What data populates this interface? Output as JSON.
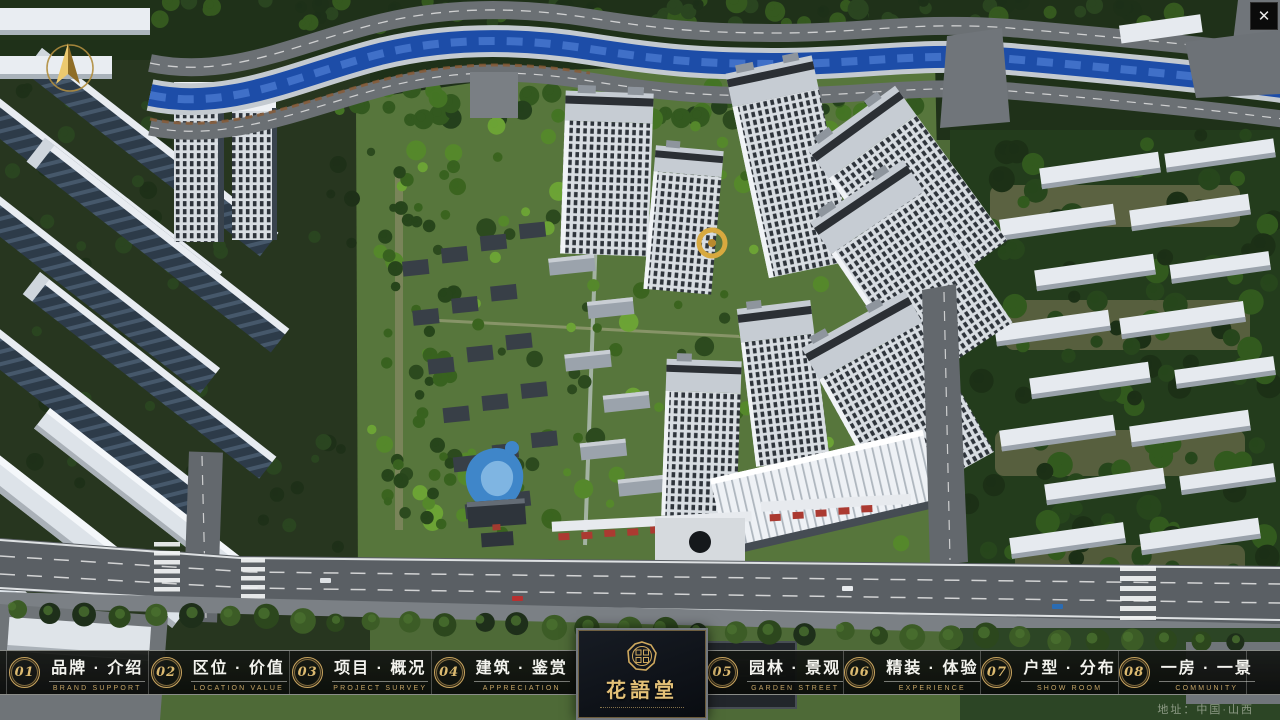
{
  "window": {
    "close": "✕"
  },
  "logo": {
    "title": "花語堂"
  },
  "nav": {
    "items": [
      {
        "num": "01",
        "zh": "品牌 · 介绍",
        "en": "BRAND SUPPORT"
      },
      {
        "num": "02",
        "zh": "区位 · 价值",
        "en": "LOCATION VALUE"
      },
      {
        "num": "03",
        "zh": "项目 · 概况",
        "en": "PROJECT SURVEY"
      },
      {
        "num": "04",
        "zh": "建筑 · 鉴赏",
        "en": "APPRECIATION"
      },
      {
        "num": "05",
        "zh": "园林 · 景观",
        "en": "GARDEN STREET"
      },
      {
        "num": "06",
        "zh": "精装 · 体验",
        "en": "EXPERIENCE"
      },
      {
        "num": "07",
        "zh": "户型 · 分布",
        "en": "SHOW ROOM"
      },
      {
        "num": "08",
        "zh": "一房 · 一景",
        "en": "COMMUNITY"
      }
    ]
  },
  "footer": {
    "address": "地址：中国·山西"
  },
  "colors": {
    "gold": "#c9a55f",
    "bar_bg": "#101310",
    "water": "#1d4da8"
  }
}
